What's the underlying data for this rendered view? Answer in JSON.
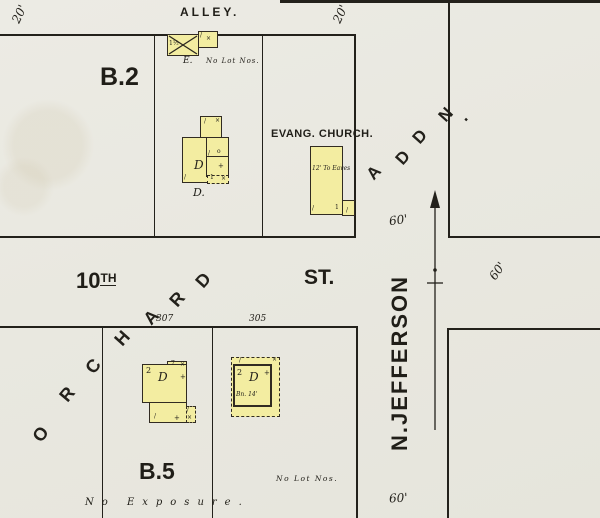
{
  "colors": {
    "paper": "#e9e8e0",
    "ink": "#23211b",
    "building_yellow": "#f3eda1"
  },
  "labels": {
    "alley": "ALLEY.",
    "block_top": "B.2",
    "block_bottom": "B.5",
    "church_name": "EVANG. CHURCH.",
    "church_note": "12' To Eaves",
    "e_building_label": "E.",
    "no_lot_nos_top": "No Lot Nos.",
    "no_lot_nos_bottom": "No Lot Nos.",
    "no_exposure": "No Exposure.",
    "d_building_label": "D.",
    "tenth_number": "10",
    "tenth_suffix": "TH",
    "tenth_st": "ST.",
    "jefferson": "N.JEFFERSON"
  },
  "diagonal_streets": {
    "orchard": {
      "name": "ORCHARD",
      "letters": [
        {
          "ch": "O",
          "x": 34,
          "y": 424,
          "r": -52
        },
        {
          "ch": "R",
          "x": 61,
          "y": 384,
          "r": -50
        },
        {
          "ch": "C",
          "x": 87,
          "y": 356,
          "r": -50
        },
        {
          "ch": "H",
          "x": 116,
          "y": 328,
          "r": -48
        },
        {
          "ch": "A",
          "x": 145,
          "y": 307,
          "r": -48
        },
        {
          "ch": "R",
          "x": 171,
          "y": 289,
          "r": -48
        },
        {
          "ch": "D",
          "x": 197,
          "y": 270,
          "r": -48
        }
      ]
    },
    "addn": {
      "name": "ADDN.",
      "letters": [
        {
          "ch": "A",
          "x": 368,
          "y": 163,
          "r": -48,
          "s": 17
        },
        {
          "ch": "D",
          "x": 397,
          "y": 148,
          "r": -48,
          "s": 17
        },
        {
          "ch": "D",
          "x": 414,
          "y": 127,
          "r": -48,
          "s": 17
        },
        {
          "ch": "N",
          "x": 440,
          "y": 105,
          "r": -48,
          "s": 17
        },
        {
          "ch": ".",
          "x": 461,
          "y": 107,
          "r": -48,
          "s": 17
        }
      ]
    }
  },
  "dimensions": [
    {
      "t": "20'",
      "x": 10,
      "y": 7,
      "r": -65
    },
    {
      "t": "20'",
      "x": 331,
      "y": 7,
      "r": -65
    },
    {
      "t": "60'",
      "x": 389,
      "y": 213,
      "r": -8
    },
    {
      "t": "60'",
      "x": 488,
      "y": 264,
      "r": -55
    },
    {
      "t": "60'",
      "x": 389,
      "y": 491,
      "r": -3
    }
  ],
  "house_numbers": [
    {
      "t": "307",
      "x": 156,
      "y": 314
    },
    {
      "t": "305",
      "x": 249,
      "y": 314
    }
  ],
  "building_marks": [
    {
      "t": "1½",
      "x": 169,
      "y": 41,
      "s": 6
    },
    {
      "t": "/",
      "x": 200,
      "y": 33,
      "s": 6
    },
    {
      "t": "×",
      "x": 206,
      "y": 36,
      "s": 6
    },
    {
      "t": "/",
      "x": 204,
      "y": 119,
      "s": 6
    },
    {
      "t": "×",
      "x": 215,
      "y": 118,
      "s": 6
    },
    {
      "t": "/",
      "x": 208,
      "y": 151,
      "s": 6
    },
    {
      "t": "o",
      "x": 217,
      "y": 149,
      "s": 6
    },
    {
      "t": "D",
      "x": 194,
      "y": 159,
      "s": 12,
      "i": true
    },
    {
      "t": "+",
      "x": 218,
      "y": 163,
      "s": 7
    },
    {
      "t": "/",
      "x": 184,
      "y": 175,
      "s": 6
    },
    {
      "t": "1",
      "x": 210,
      "y": 175,
      "s": 6
    },
    {
      "t": "×",
      "x": 221,
      "y": 176,
      "s": 6
    },
    {
      "t": "/",
      "x": 312,
      "y": 206,
      "s": 6
    },
    {
      "t": "1",
      "x": 335,
      "y": 205,
      "s": 6
    },
    {
      "t": "/",
      "x": 346,
      "y": 208,
      "s": 6
    },
    {
      "t": "2",
      "x": 146,
      "y": 367,
      "s": 8
    },
    {
      "t": "7",
      "x": 171,
      "y": 361,
      "s": 6
    },
    {
      "t": "×",
      "x": 180,
      "y": 362,
      "s": 6
    },
    {
      "t": "D",
      "x": 158,
      "y": 371,
      "s": 12,
      "i": true
    },
    {
      "t": "+",
      "x": 180,
      "y": 374,
      "s": 7
    },
    {
      "t": "/",
      "x": 154,
      "y": 414,
      "s": 6
    },
    {
      "t": "+",
      "x": 174,
      "y": 415,
      "s": 7
    },
    {
      "t": "/",
      "x": 187,
      "y": 407,
      "s": 6
    },
    {
      "t": "×",
      "x": 187,
      "y": 415,
      "s": 6
    },
    {
      "t": "/",
      "x": 239,
      "y": 358,
      "s": 6
    },
    {
      "t": "×",
      "x": 272,
      "y": 357,
      "s": 6
    },
    {
      "t": "2",
      "x": 237,
      "y": 369,
      "s": 8
    },
    {
      "t": "D",
      "x": 249,
      "y": 371,
      "s": 12,
      "i": true
    },
    {
      "t": "+",
      "x": 264,
      "y": 370,
      "s": 7
    },
    {
      "t": "Bn. 14'",
      "x": 236,
      "y": 392,
      "s": 6,
      "i": true
    }
  ]
}
